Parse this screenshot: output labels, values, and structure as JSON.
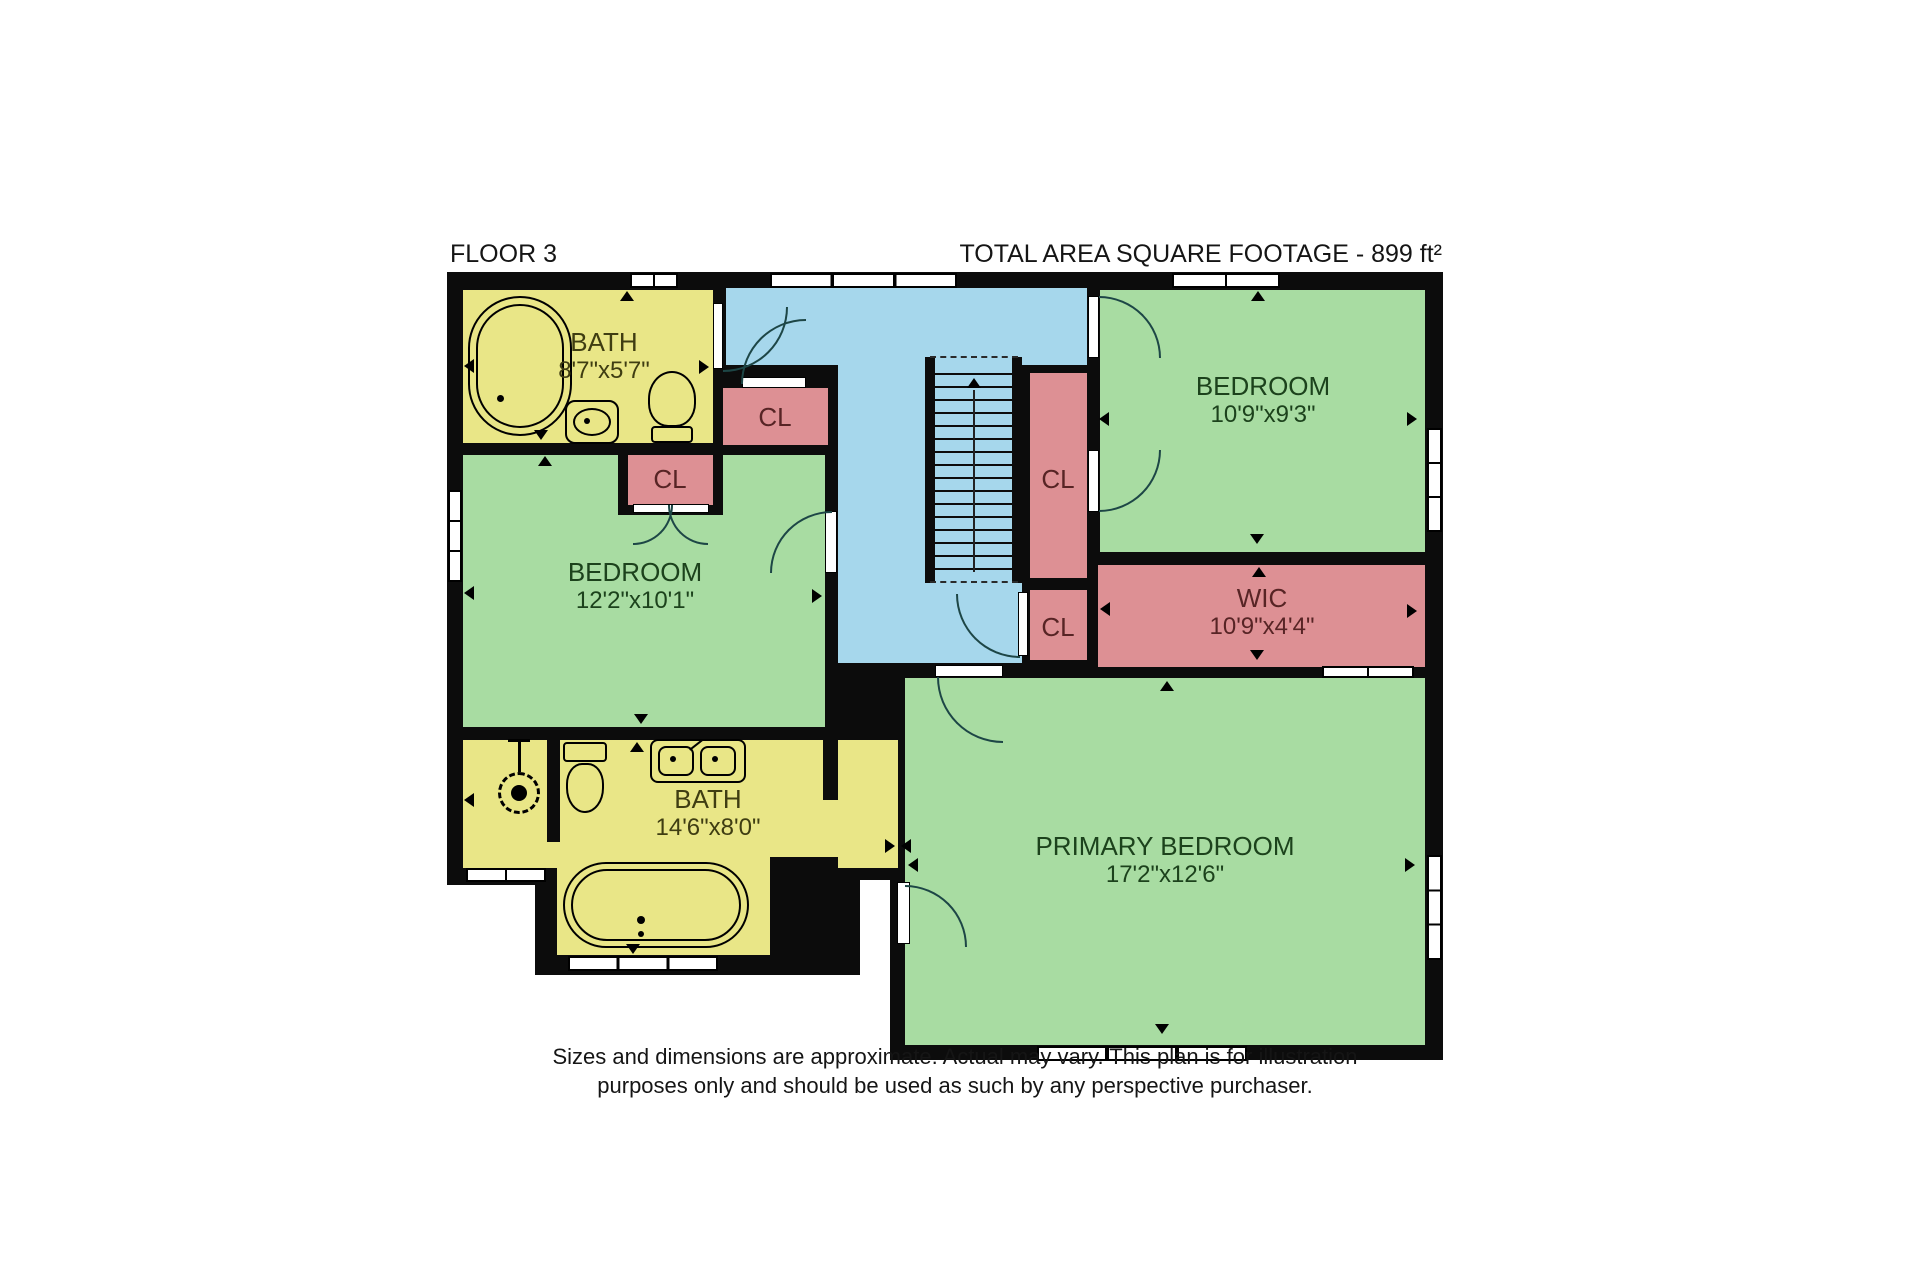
{
  "header": {
    "floor_label": "FLOOR 3",
    "total_area_label": "TOTAL AREA SQUARE FOOTAGE - 899 ft²"
  },
  "rooms": {
    "bath_top": {
      "name": "BATH",
      "dims": "8'7\"x5'7\""
    },
    "bedroom_left": {
      "name": "BEDROOM",
      "dims": "12'2\"x10'1\""
    },
    "bedroom_top_right": {
      "name": "BEDROOM",
      "dims": "10'9\"x9'3\""
    },
    "wic": {
      "name": "WIC",
      "dims": "10'9\"x4'4\""
    },
    "bath_bottom": {
      "name": "BATH",
      "dims": "14'6\"x8'0\""
    },
    "primary_bedroom": {
      "name": "PRIMARY BEDROOM",
      "dims": "17'2\"x12'6\""
    },
    "closet_1": {
      "name": "CL"
    },
    "closet_2": {
      "name": "CL"
    },
    "closet_3": {
      "name": "CL"
    },
    "closet_4": {
      "name": "CL"
    }
  },
  "footer": {
    "disclaimer_line1": "Sizes and dimensions are approximate. Actual may vary. This plan is for illustration",
    "disclaimer_line2": "purposes only and should be used as such by any perspective purchaser."
  },
  "colors": {
    "wall": "#0c0c0c",
    "bedroom_fill": "#a8dca2",
    "bath_fill": "#e9e687",
    "closet_fill": "#dd9094",
    "hall_fill": "#a6d7ec",
    "window_fill": "#ffffff"
  },
  "icons": {
    "fixtures": [
      "bathtub-icon",
      "toilet-icon",
      "sink-icon",
      "double-sink-icon",
      "shower-head-icon",
      "staircase-icon",
      "door-swing-icon",
      "window-icon",
      "direction-arrow-icon"
    ]
  }
}
